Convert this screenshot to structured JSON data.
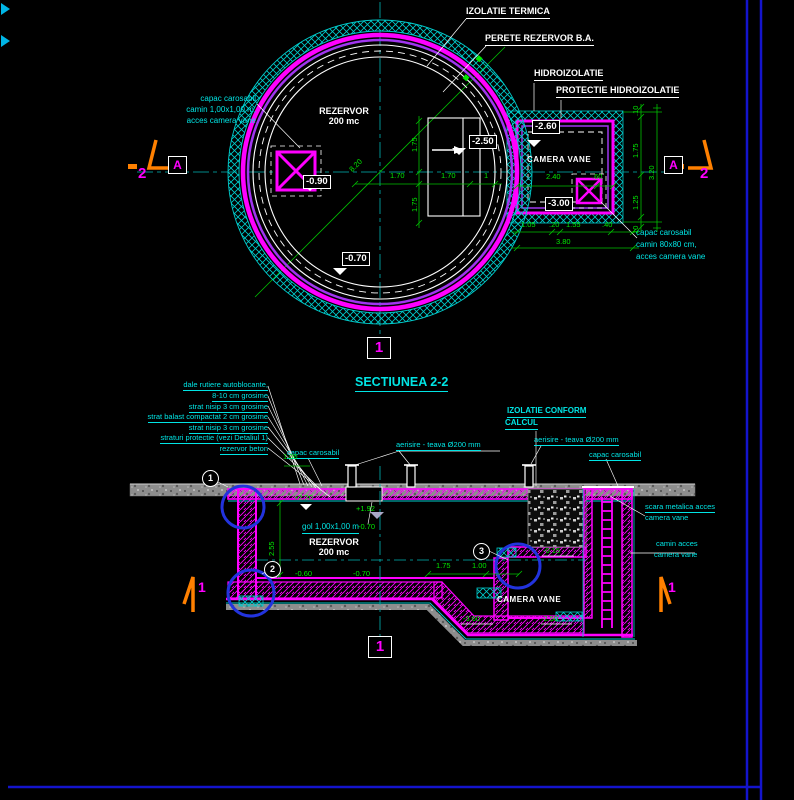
{
  "colors": {
    "background": "#000000",
    "magenta": "#ff00ff",
    "violet": "#a035f0",
    "cyan": "#00e5e5",
    "green": "#00e800",
    "white": "#ffffff",
    "orange": "#ff8000",
    "detail_blue": "#2233dd",
    "frame_blue": "#1414cc",
    "terrain_gray": "#8d8d8d"
  },
  "plan": {
    "callout_izolatie": "IZOLATIE TERMICA",
    "callout_perete": "PERETE REZERVOR B.A.",
    "callout_hidro": "HIDROIZOLATIE",
    "callout_protectie": "PROTECTIE HIDROIZOLATIE",
    "note_left": {
      "l1": "capac carosabil",
      "l2": "camin 1,00x1,00 m,",
      "l3": "acces camera vane"
    },
    "note_right": {
      "l1": "capac carosabil",
      "l2": "camin 80x80 cm,",
      "l3": "acces camera vane"
    },
    "rezervor_l1": "REZERVOR",
    "rezervor_l2": "200 mc",
    "camera_vane": "CAMERA VANE",
    "elev": {
      "e090": "-0.90",
      "e070": "-0.70",
      "e250": "-2.50",
      "e260": "-2.60",
      "e300": "-3.00"
    },
    "dims": {
      "d170a": "1.70",
      "d170b": "1.70",
      "d1": "1",
      "d175a": "1.75",
      "d175b": "1.75",
      "d820": "8.20",
      "d240": "2.40",
      "d060": ".60",
      "d105": "1.05",
      "d020": ".20",
      "d155": "1.55",
      "d040": ".40",
      "d380": "3.80",
      "d010a": ".10",
      "dv175": "1.75",
      "dv125": "1.25",
      "d010b": ".10",
      "d320": "3.20"
    },
    "markers": {
      "m2l": "2",
      "mAl": "A",
      "mAr": "A",
      "m2r": "2",
      "axis1": "1"
    }
  },
  "section": {
    "title": "SECTIUNEA 2-2",
    "notes_left": [
      "dale rutiere autoblocante,",
      "8-10 cm grosime",
      "strat nisip 3 cm grosime",
      "strat balast compactat 2 cm grosime",
      "strat nisip 3 cm grosime",
      "straturi protectie (vezi Detaliul 1)",
      "rezervor beton"
    ],
    "capac_left": "capac carosabil",
    "aerisire_left": "aerisire - teava Ø200 mm",
    "izolatie_l1": "IZOLATIE CONFORM",
    "izolatie_l2": "CALCUL",
    "aerisire_right": "aerisire - teava Ø200 mm",
    "capac_right": "capac carosabil",
    "scara_l1": "scara metalica acces",
    "scara_l2": "camera vane",
    "camin_l1": "camin acces",
    "camin_l2": "camera vane",
    "gol": "gol 1,00x1,00 m",
    "rezervor_l1": "REZERVOR",
    "rezervor_l2": "200 mc",
    "camera_vane": "CAMERA VANE",
    "elev": {
      "p220": "+2.20",
      "p192": "+1.92",
      "m070a": "-0.70",
      "m060": "-0.60",
      "m070b": "-0.70",
      "m015": "-0.15",
      "m360": "-3.60",
      "m250": "-2.50"
    },
    "dims": {
      "d255": "2.55",
      "d100top": "1.00",
      "d175": "1.75",
      "d100": "1.00"
    },
    "markers": {
      "c1": "1",
      "c2": "2",
      "c3": "3",
      "s1l": "1",
      "s1r": "1",
      "axis1": "1"
    }
  }
}
